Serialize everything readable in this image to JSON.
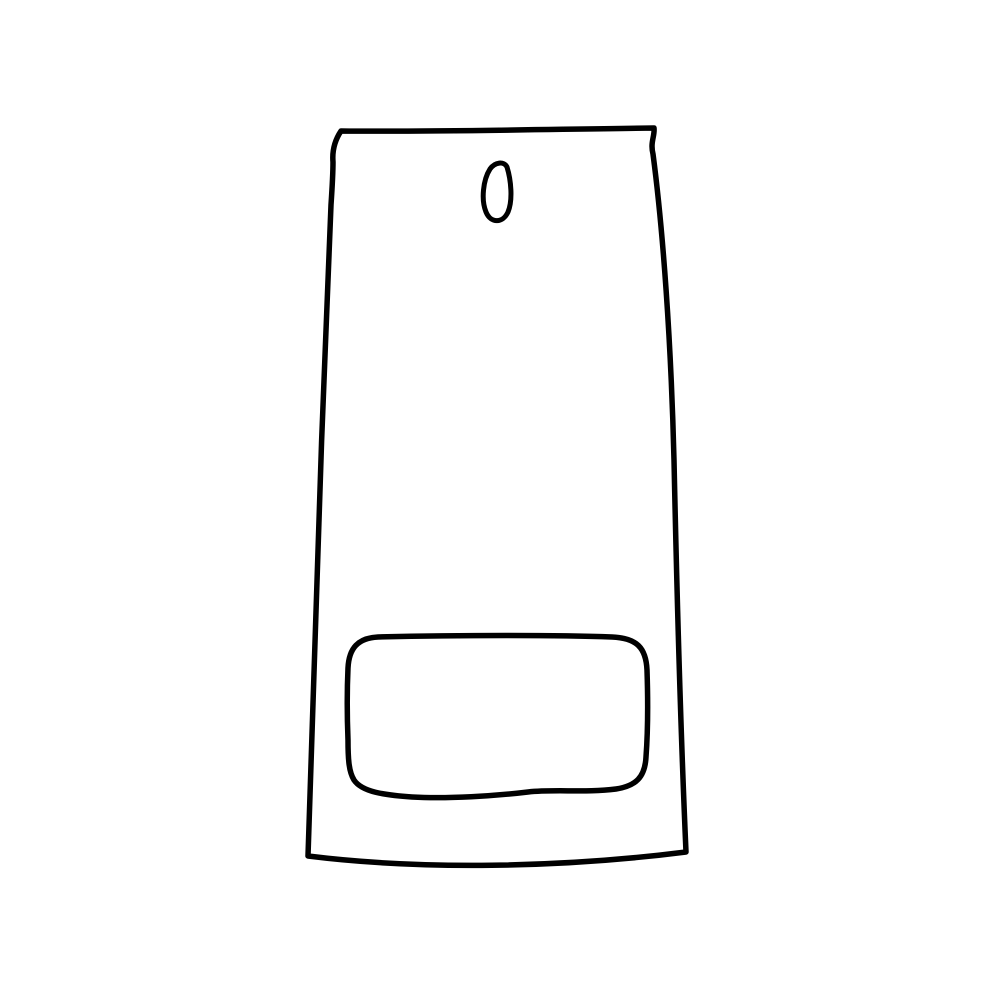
{
  "illustration": {
    "title": "Hand-drawn line art of a wall-mounted dispenser: tall tapered body with a teardrop hanging hole near the top center and a rounded-rectangle front pocket with a wavy lower edge near the bottom",
    "background_color": "#ffffff",
    "stroke_color": "#000000",
    "elements": [
      {
        "name": "body-outline",
        "description": "tall body, slightly narrower at top, sides flaring gently outward, bottom edge sagging in a shallow curve, small curled hooks at both top corners"
      },
      {
        "name": "hanging-hole",
        "description": "small teardrop-shaped hole with pointed tip at upper right, located near top center of the body"
      },
      {
        "name": "front-pocket",
        "description": "wide rounded rectangle pocket in the lower third of the body with a slightly wavy bottom edge"
      }
    ]
  }
}
